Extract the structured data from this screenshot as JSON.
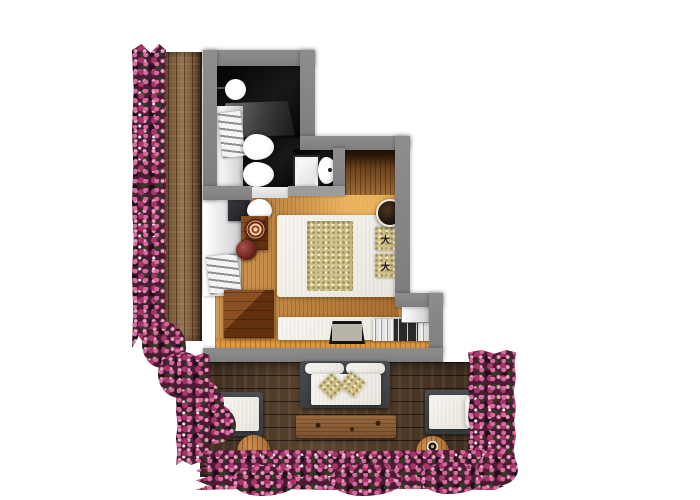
{
  "meta": {
    "type": "3d-floor-plan-render",
    "description": "Top-down photorealistic rendering of a studio hotel suite: dark bathroom (top), wood-floor bedroom (center), flower-lined side balcony (left) and large furnished wooden terrace (bottom). No text labels are rendered in the image."
  },
  "palette": {
    "background": "#ffffff",
    "wall_gray": "#868686",
    "bathroom_floor": "#0d0d0d",
    "bedroom_wood": "#bb813f",
    "bedroom_wood_glow": "#ec9f3d",
    "balcony_wood": "#7b5a3a",
    "terrace_wood": "#4a3625",
    "wardrobe_niche_wood": "#6f4520",
    "flower_pink": "#c45585",
    "flower_foliage": "#2e1b24",
    "linen_white": "#f1efe9",
    "cushion_tan": "#cfc08c",
    "dark_furniture_wood": "#6e3c1b",
    "outdoor_frame_gray": "#44474b",
    "round_table_wood": "#b5793c"
  },
  "rooms": {
    "bathroom": {
      "fixtures": [
        "round-basin",
        "faucet",
        "vanity-counter",
        "towel-radiator",
        "toilet",
        "bidet",
        "shower-tray",
        "oval-basin"
      ]
    },
    "bedroom": {
      "furniture": [
        "wall-closet",
        "tv-panel",
        "desk-chair",
        "desk",
        "decor-medallion",
        "stool",
        "dresser",
        "double-bed",
        "printed-pillows",
        "round-side-table",
        "wardrobe-niche",
        "window-bench",
        "serving-tray",
        "book-row",
        "wall-shelf"
      ]
    },
    "balcony_left": {
      "features": [
        "wood-deck",
        "flower-border"
      ]
    },
    "terrace": {
      "furniture": [
        "outdoor-sofa",
        "sofa-pillows",
        "armchair-left",
        "armchair-right",
        "coffee-table",
        "round-table-left",
        "round-table-right",
        "coffee-cups"
      ],
      "features": [
        "wood-deck",
        "flower-border"
      ]
    }
  },
  "decor": {
    "pillow_print_glyph": "大",
    "printed_pillow_count": 2,
    "coffee_cup_count": 3
  }
}
